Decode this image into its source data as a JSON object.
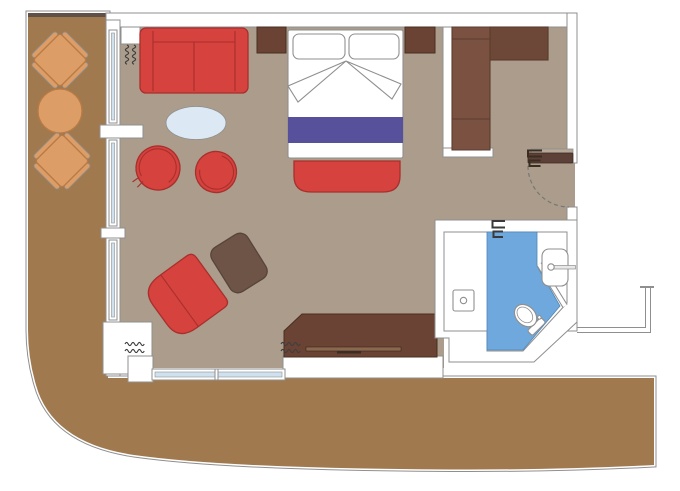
{
  "floor_plan": {
    "type": "suite-cabin-floor-plan",
    "rooms": {
      "balcony": {
        "items": [
          "deck-chair",
          "round-table",
          "deck-chair"
        ]
      },
      "living_area": {
        "items": [
          "sofa",
          "side-table",
          "coffee-table",
          "swivel-chair",
          "swivel-chair",
          "lounge-chair",
          "ottoman",
          "desk"
        ]
      },
      "sleeping_area": {
        "items": [
          "double-bed",
          "pillow",
          "pillow",
          "bed-runner",
          "foot-bench",
          "nightstand",
          "nightstand"
        ]
      },
      "entry": {
        "items": [
          "entry-door",
          "wardrobe"
        ]
      },
      "bathroom": {
        "items": [
          "shower-drain",
          "toilet",
          "washbasin"
        ]
      }
    }
  },
  "colors": {
    "deck": "#a1794f",
    "deck_top_edge": "#5f5148",
    "floor": "#ab9c8b",
    "red": "#d6423e",
    "red_dark": "#a82f2c",
    "wood_dark": "#6a4334",
    "wood_stroke": "#4a2f22",
    "wardrobe_wood": "#7b5242",
    "wardrobe_shadow": "#6d4737",
    "wardrobe_stroke": "#5a3c2d",
    "ottoman_brown": "#6d5446",
    "ottoman_stroke": "#57443a",
    "purple": "#57509b",
    "table_blue": "#dce8f4",
    "table_blue_stroke": "#a8c2d8",
    "bath_blue": "#6fa8dc",
    "bath_blue_dark": "#4e86b8",
    "orange": "#dd9d66",
    "orange_dark": "#b97a45",
    "glass": "#cfe0ee",
    "outline": "#8f8f8f",
    "curtain": "#3f3f3f",
    "door_wood": "#5d4037",
    "door_frame": "#b7a797",
    "desk_handle": "#8a6850",
    "mark_dark": "#3a2d22",
    "mark_slate": "#3a3a3a"
  }
}
